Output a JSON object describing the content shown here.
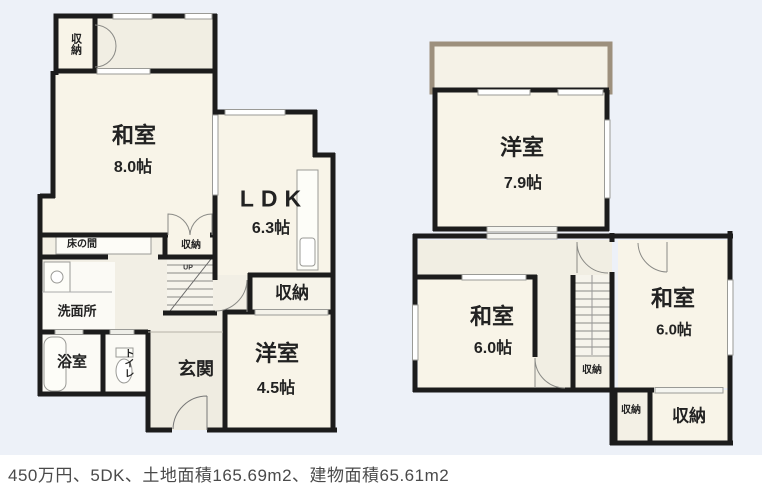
{
  "listing": {
    "summary": "450万円、5DK、土地面積165.69m2、建物面積65.61m2"
  },
  "f1": {
    "closet_top": "収納",
    "washitsu": {
      "name": "和室",
      "size": "8.0帖"
    },
    "ldk": {
      "name": "LDK",
      "size": "6.3帖"
    },
    "tokonoma": "床の間",
    "closet_stairs": "収納",
    "stairs_up": "UP",
    "closet_ldk": "収納",
    "yoshitsu": {
      "name": "洋室",
      "size": "4.5帖"
    },
    "senmenjo": "洗面所",
    "yokushitsu": "浴室",
    "toilet": "トイレ",
    "genkan": "玄関"
  },
  "f2": {
    "yoshitsu": {
      "name": "洋室",
      "size": "7.9帖"
    },
    "washitsu_left": {
      "name": "和室",
      "size": "6.0帖"
    },
    "washitsu_right": {
      "name": "和室",
      "size": "6.0帖"
    },
    "closet_stairs": "収納",
    "closet_small": "収納",
    "closet_large": "収納"
  },
  "colors": {
    "wall": "#1c1c1c",
    "room_fill": "#f8f4e8",
    "corridor_fill": "#f1eee3",
    "background": "#edf1f8",
    "balcony_border": "#9d907d",
    "caption_text": "#4a4a4a"
  }
}
